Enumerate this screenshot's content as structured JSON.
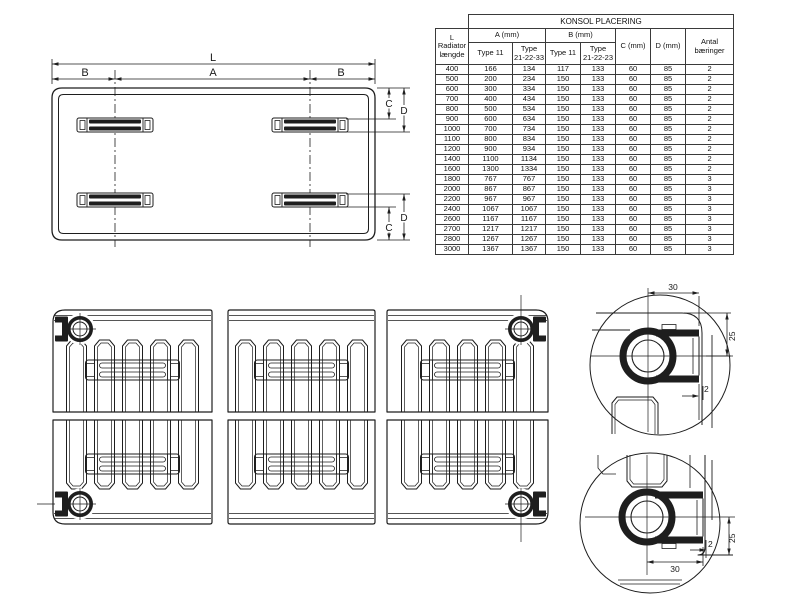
{
  "table": {
    "title": "KONSOL PLACERING",
    "col_l_header": "L\nRadiator\nlængde",
    "col_a_header": "A (mm)",
    "col_b_header": "B (mm)",
    "col_c_header": "C (mm)",
    "col_d_header": "D (mm)",
    "col_antal_header": "Antal\nbæringer",
    "sub_a_type11": "Type 11",
    "sub_a_type21": "Type\n21-22-33",
    "sub_b_type11": "Type 11",
    "sub_b_type21": "Type\n21-22-23",
    "rows": [
      [
        "400",
        "166",
        "134",
        "117",
        "133",
        "60",
        "85",
        "2"
      ],
      [
        "500",
        "200",
        "234",
        "150",
        "133",
        "60",
        "85",
        "2"
      ],
      [
        "600",
        "300",
        "334",
        "150",
        "133",
        "60",
        "85",
        "2"
      ],
      [
        "700",
        "400",
        "434",
        "150",
        "133",
        "60",
        "85",
        "2"
      ],
      [
        "800",
        "500",
        "534",
        "150",
        "133",
        "60",
        "85",
        "2"
      ],
      [
        "900",
        "600",
        "634",
        "150",
        "133",
        "60",
        "85",
        "2"
      ],
      [
        "1000",
        "700",
        "734",
        "150",
        "133",
        "60",
        "85",
        "2"
      ],
      [
        "1100",
        "800",
        "834",
        "150",
        "133",
        "60",
        "85",
        "2"
      ],
      [
        "1200",
        "900",
        "934",
        "150",
        "133",
        "60",
        "85",
        "2"
      ],
      [
        "1400",
        "1100",
        "1134",
        "150",
        "133",
        "60",
        "85",
        "2"
      ],
      [
        "1600",
        "1300",
        "1334",
        "150",
        "133",
        "60",
        "85",
        "2"
      ],
      [
        "1800",
        "767",
        "767",
        "150",
        "133",
        "60",
        "85",
        "3"
      ],
      [
        "2000",
        "867",
        "867",
        "150",
        "133",
        "60",
        "85",
        "3"
      ],
      [
        "2200",
        "967",
        "967",
        "150",
        "133",
        "60",
        "85",
        "3"
      ],
      [
        "2400",
        "1067",
        "1067",
        "150",
        "133",
        "60",
        "85",
        "3"
      ],
      [
        "2600",
        "1167",
        "1167",
        "150",
        "133",
        "60",
        "85",
        "3"
      ],
      [
        "2700",
        "1217",
        "1217",
        "150",
        "133",
        "60",
        "85",
        "3"
      ],
      [
        "2800",
        "1267",
        "1267",
        "150",
        "133",
        "60",
        "85",
        "3"
      ],
      [
        "3000",
        "1367",
        "1367",
        "150",
        "133",
        "60",
        "85",
        "3"
      ]
    ]
  },
  "plan_view": {
    "dim_l": "L",
    "dim_a": "A",
    "dim_b_left": "B",
    "dim_b_right": "B",
    "dim_c_top": "C",
    "dim_d_top": "D",
    "dim_c_bottom": "C",
    "dim_d_bottom": "D"
  },
  "detail_top": {
    "dim_width": "30",
    "dim_height": "25",
    "dim_lip": "2"
  },
  "detail_bottom": {
    "dim_width": "30",
    "dim_height": "25",
    "dim_lip": "2"
  },
  "colors": {
    "line": "#1e1e1e",
    "background": "#ffffff"
  }
}
